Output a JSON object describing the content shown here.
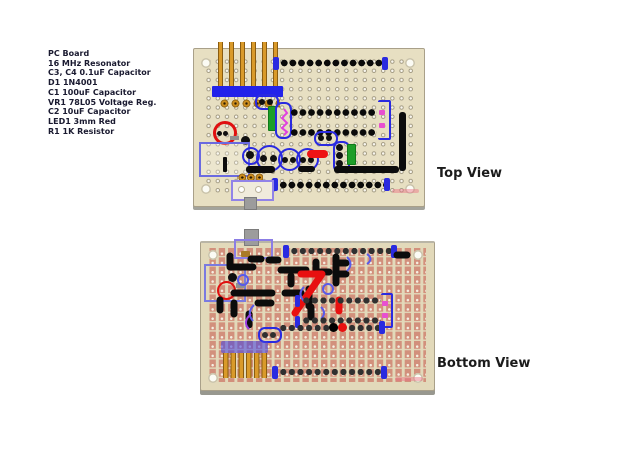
{
  "parts_list": {
    "items": [
      "PC Board",
      "16 MHz Resonator",
      "C3, C4 0.1uF Capacitor",
      "D1 1N4001",
      "C1 100uF Capacitor",
      "VR1 78L05 Voltage Reg.",
      "C2 10uF Capacitor",
      "LED1 3mm Red",
      "R1 1K Resistor"
    ]
  },
  "views": {
    "top_label": "Top View",
    "bottom_label": "Bottom View"
  },
  "colors": {
    "background": "#ffffff",
    "board_top_substrate": "#e7dfc2",
    "board_bottom_substrate": "#e2d9ba",
    "copper_pad": "#d2907c",
    "component_outline_blue": "#2a2ae0",
    "outline_periwinkle": "#7a7ae0",
    "wire_black": "#0c0c0c",
    "wire_red": "#e81010",
    "led_red": "#e01010",
    "capacitor_green": "#1e9e28",
    "header_gold": "#cf8f1e",
    "resonator_magenta": "#e040e0",
    "text": "#1a1a30"
  }
}
